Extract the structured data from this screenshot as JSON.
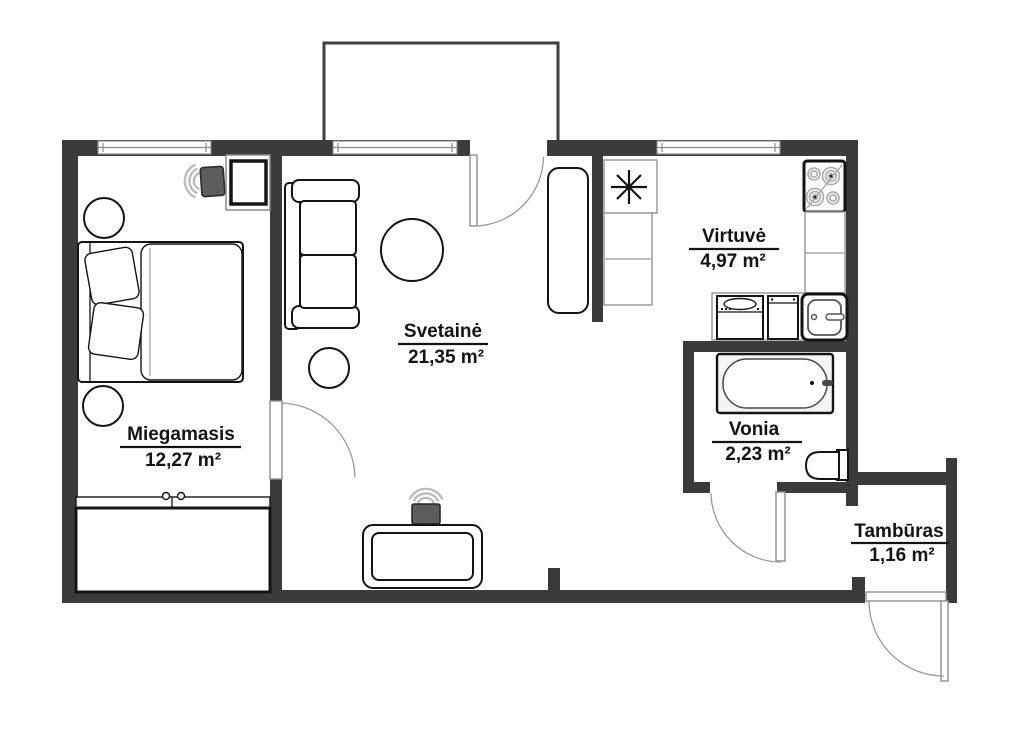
{
  "plan": {
    "background_color": "#ffffff",
    "wall_color": "#3b3b3b",
    "line_color": "#141414",
    "rooms": [
      {
        "name": "Miegamasis",
        "area": "12,27 m²"
      },
      {
        "name": "Svetainė",
        "area": "21,35 m²"
      },
      {
        "name": "Virtuvė",
        "area": "4,97 m²"
      },
      {
        "name": "Vonia",
        "area": "2,23 m²"
      },
      {
        "name": "Tambūras",
        "area": "1,16 m²"
      }
    ],
    "icons": {
      "fridge": "snowflake-icon",
      "stove": "four-burner-stove-icon",
      "tv": "tv-with-signal-arcs-icon"
    }
  }
}
